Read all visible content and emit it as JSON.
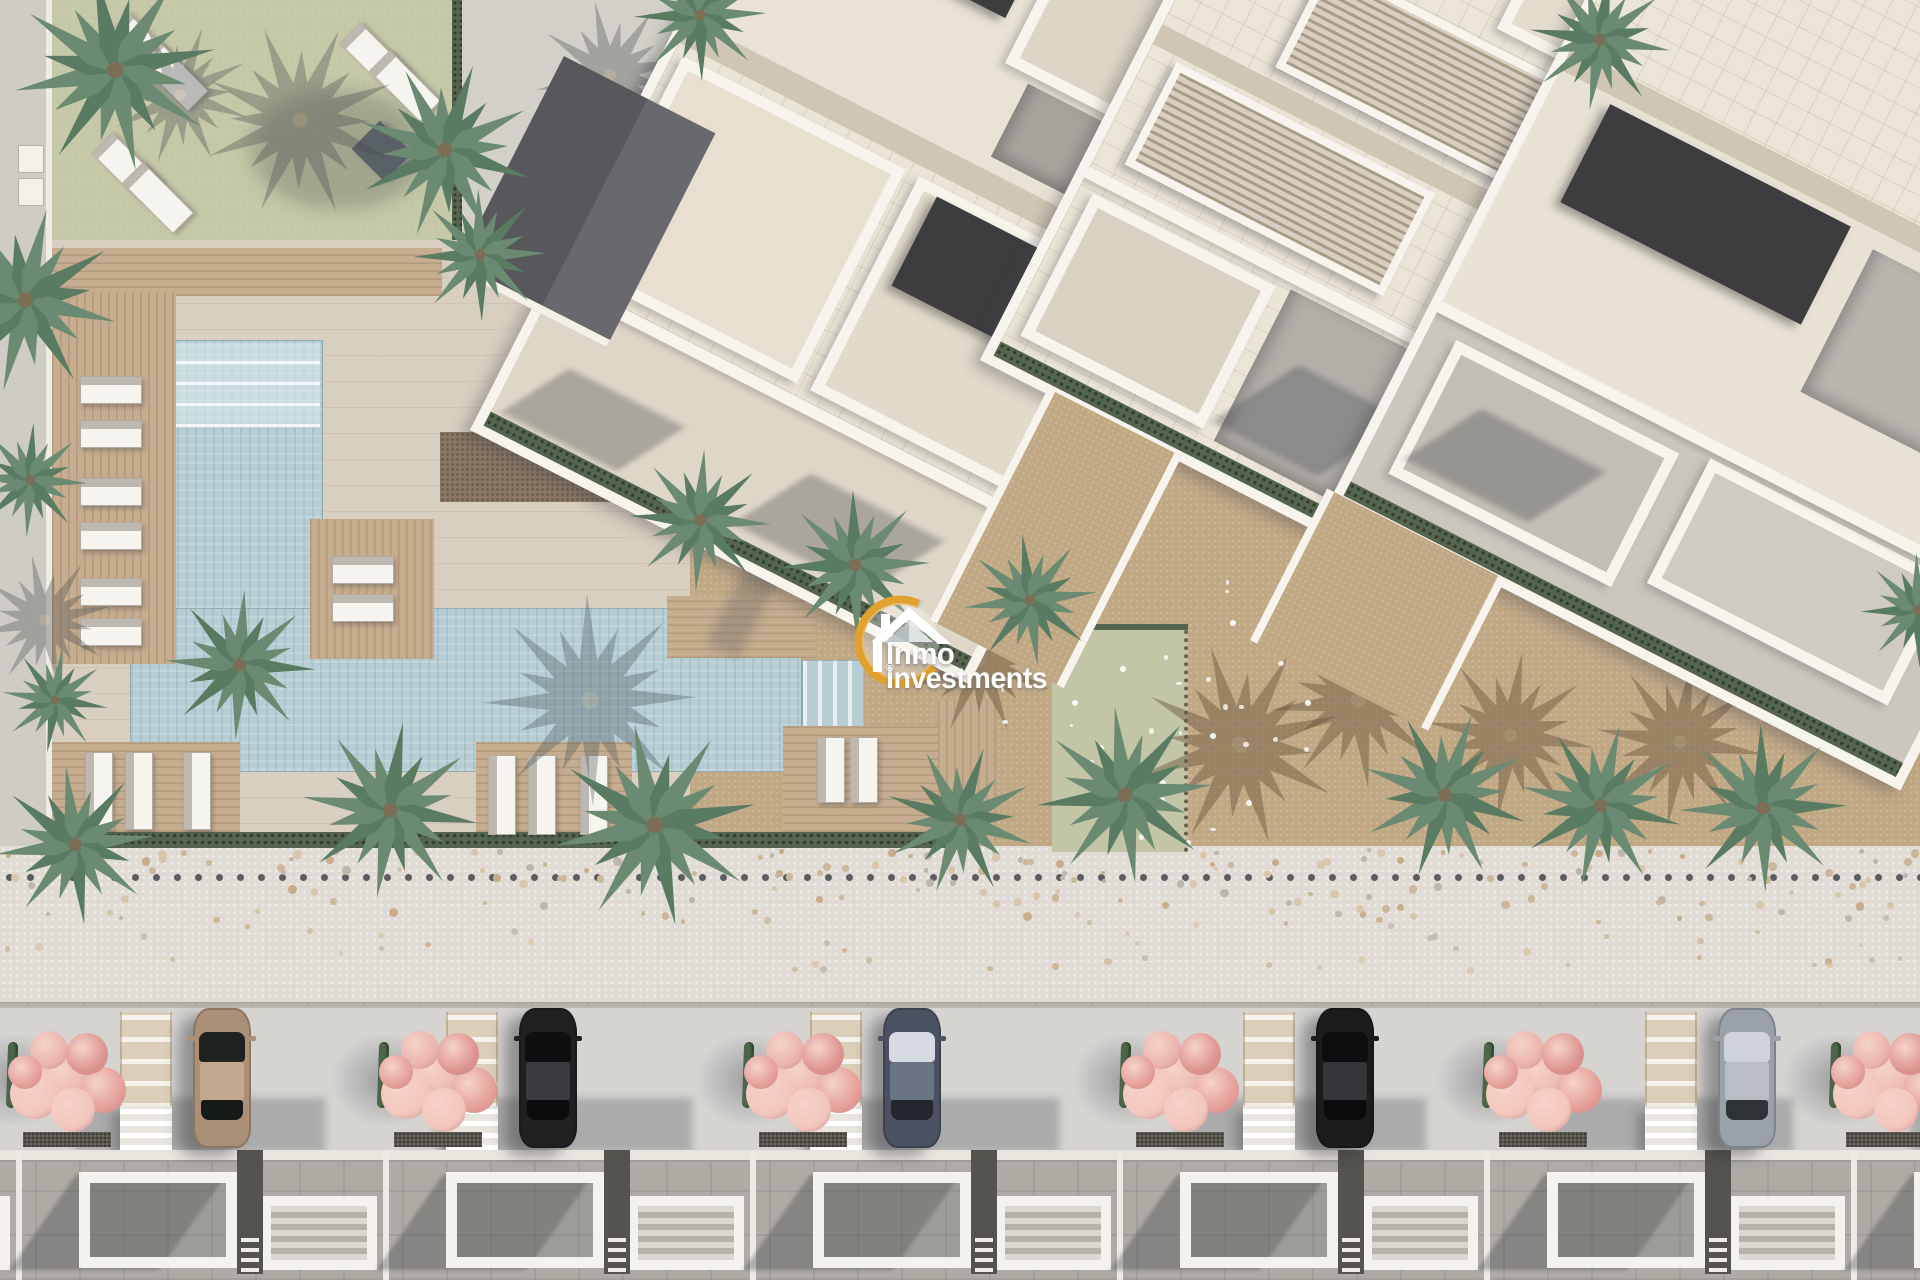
{
  "watermark": {
    "brand_line1": "Inmo",
    "brand_line2": "Investments",
    "registered_mark": "®",
    "ring_color": "#e0a12f",
    "text_color": "#fcfcfa"
  },
  "palette": {
    "pavement": "#d2cfc8",
    "pavement_warm": "#d9cfc0",
    "lawn": "#c5c8a7",
    "sand": "#c1a884",
    "pool": "#b7ced4",
    "wood": "#c7ad8f",
    "building_floor": "#ebe5d7",
    "parapet": "#f7f4ed",
    "roof_dark": "#3d3d3f",
    "solar": "#2f3747",
    "hedge": "#55644f",
    "street": "#d5d4d1",
    "promenade": "#e0dcd5",
    "blossom": "#e8a9a3",
    "palm_main": "#6b8a72",
    "palm_alt": "#587b62"
  },
  "scene": {
    "palms": [
      [
        115,
        70,
        230,
        10
      ],
      [
        25,
        300,
        210,
        80
      ],
      [
        30,
        480,
        130,
        160
      ],
      [
        445,
        150,
        200,
        40
      ],
      [
        480,
        255,
        150,
        200
      ],
      [
        55,
        700,
        120,
        120
      ],
      [
        75,
        845,
        180,
        330
      ],
      [
        240,
        665,
        170,
        250
      ],
      [
        390,
        810,
        200,
        30
      ],
      [
        655,
        825,
        230,
        100
      ],
      [
        960,
        820,
        170,
        310
      ],
      [
        700,
        15,
        150,
        200
      ],
      [
        1600,
        40,
        160,
        300
      ],
      [
        700,
        520,
        160,
        70
      ],
      [
        855,
        565,
        170,
        290
      ],
      [
        1030,
        600,
        150,
        150
      ],
      [
        1125,
        795,
        200,
        60
      ],
      [
        1445,
        795,
        190,
        130
      ],
      [
        1600,
        805,
        185,
        260
      ],
      [
        1763,
        808,
        190,
        20
      ],
      [
        1918,
        610,
        130,
        200
      ]
    ],
    "palm_shadows": [
      [
        300,
        120,
        220,
        0,
        "grey"
      ],
      [
        180,
        95,
        160,
        40,
        "grey"
      ],
      [
        590,
        700,
        240,
        20,
        "pool"
      ],
      [
        610,
        75,
        170,
        10,
        "grey"
      ],
      [
        980,
        660,
        170,
        90,
        "sand"
      ],
      [
        1240,
        745,
        230,
        50,
        "sand"
      ],
      [
        1358,
        700,
        200,
        150,
        "sand"
      ],
      [
        1510,
        735,
        190,
        210,
        "sand"
      ],
      [
        1680,
        742,
        190,
        300,
        "sand"
      ],
      [
        45,
        620,
        150,
        100,
        "grey"
      ]
    ],
    "lawn_loungers": [
      [
        128,
        12
      ],
      [
        158,
        40
      ],
      [
        112,
        132
      ],
      [
        143,
        162
      ],
      [
        360,
        22
      ],
      [
        390,
        50
      ]
    ],
    "west_deck_loungers_y": [
      376,
      420,
      478,
      522,
      578,
      618
    ],
    "island_loungers_y": [
      556,
      594
    ],
    "deck_a_loungers_x": [
      488,
      528,
      580
    ],
    "deck_b_loungers_x": [
      817,
      850
    ],
    "west_bottom_loungers_x": [
      85,
      125,
      183
    ],
    "left_planters_y": [
      145,
      178
    ],
    "cars": [
      {
        "x": 222,
        "body": "#ab9077",
        "roof": "#c2a98f",
        "glass_top": "#1d241f",
        "glass_bottom": "#151a16"
      },
      {
        "x": 548,
        "body": "#202123",
        "roof": "#3a3c3f",
        "glass_top": "#0e0f11",
        "glass_bottom": "#0b0c0d"
      },
      {
        "x": 912,
        "body": "#4a5160",
        "roof": "#6a7382",
        "glass_top": "#d6dbe1",
        "glass_bottom": "#23262c"
      },
      {
        "x": 1345,
        "body": "#1b1c1e",
        "roof": "#343639",
        "glass_top": "#0d0e10",
        "glass_bottom": "#0a0b0c"
      },
      {
        "x": 1747,
        "body": "#9aa1a8",
        "roof": "#b8bec4",
        "glass_top": "#cdd3d8",
        "glass_bottom": "#2e3136"
      }
    ],
    "pink_trees_x": [
      67,
      438,
      803,
      1180,
      1543,
      1890
    ],
    "blossom_offsets": [
      [
        0,
        0,
        62
      ],
      [
        36,
        12,
        46
      ],
      [
        -32,
        16,
        50
      ],
      [
        20,
        -24,
        42
      ],
      [
        -18,
        -28,
        38
      ],
      [
        6,
        32,
        44
      ],
      [
        -42,
        -6,
        34
      ]
    ],
    "blossom_colors": [
      "#eab3ab",
      "#e49e98",
      "#f2c6bd",
      "#dd938f",
      "#eab3ab",
      "#f2c6bd",
      "#e49e98"
    ],
    "ladders_x": [
      120,
      446,
      810,
      1243,
      1645
    ],
    "houses_x": [
      -332,
      35,
      402,
      769,
      1136,
      1503,
      1870
    ],
    "pebbles": [
      [
        1005,
        598
      ],
      [
        1043,
        652
      ],
      [
        1072,
        700
      ],
      [
        1120,
        666
      ],
      [
        1098,
        745
      ],
      [
        1160,
        780
      ],
      [
        1210,
        733
      ],
      [
        1246,
        800
      ],
      [
        1185,
        840
      ],
      [
        1080,
        815
      ],
      [
        1230,
        620
      ],
      [
        1305,
        700
      ]
    ],
    "dark_dot_row": {
      "y": 874,
      "start": 6,
      "step": 21,
      "size": 7,
      "count": 92,
      "color": "#5c5d61"
    },
    "tan_dots": {
      "seed": 7,
      "dense_count": 170,
      "sparse_count": 55,
      "colors": [
        "#c9ad8b",
        "#d8c6ab",
        "#bdb6ac",
        "#cbb89b"
      ]
    }
  }
}
